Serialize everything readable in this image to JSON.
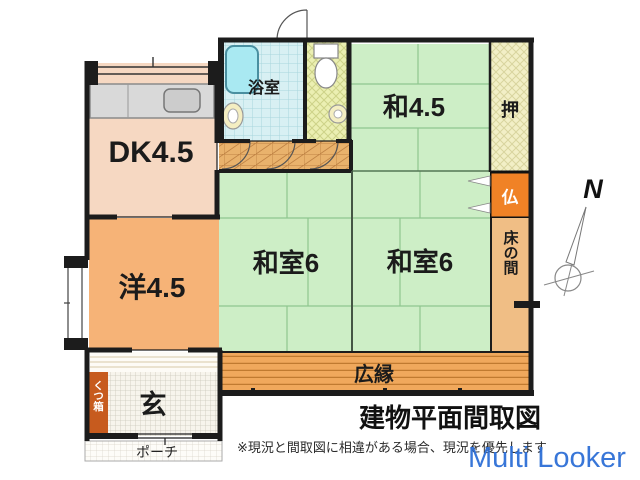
{
  "plan": {
    "rooms": {
      "dk": "DK4.5",
      "western": "洋4.5",
      "washitsu45": "和4.5",
      "washitsu6_left": "和室6",
      "washitsu6_right": "和室6",
      "bathroom": "浴室",
      "closet": "押",
      "butsudan": "仏",
      "tokonoma": "床の間",
      "veranda": "広縁",
      "entrance": "玄",
      "shoe_box": "くつ箱",
      "porch": "ポーチ"
    },
    "compass_label": "N"
  },
  "caption": {
    "title": "建物平面間取図",
    "disclaimer": "※現況と間取図に相違がある場合、現況を優先します"
  },
  "watermark": "Multi Looker",
  "colors": {
    "wall": "#1c1c1c",
    "dk_fill": "#f6d8c2",
    "western_fill": "#f6b377",
    "tatami_fill": "#cdeec6",
    "tatami_line": "#8fc68f",
    "closet_fill": "#f2efc6",
    "butsudan_fill": "#f08226",
    "tokonoma_fill": "#f0be85",
    "veranda_fill": "#f0a85c",
    "veranda_line": "#c07a30",
    "hallway_fill": "#e9b26c",
    "bath_fill": "#d8f0f3",
    "bathtub_fill": "#a9e9f2",
    "toilet_fill": "#ebefb2",
    "genkan_fill": "#f7f4ec",
    "shoebox_fill": "#c75b1e",
    "counter_fill": "#d9d9d9",
    "watermark_blue": "#2e6fd6",
    "title_color": "#111111"
  }
}
